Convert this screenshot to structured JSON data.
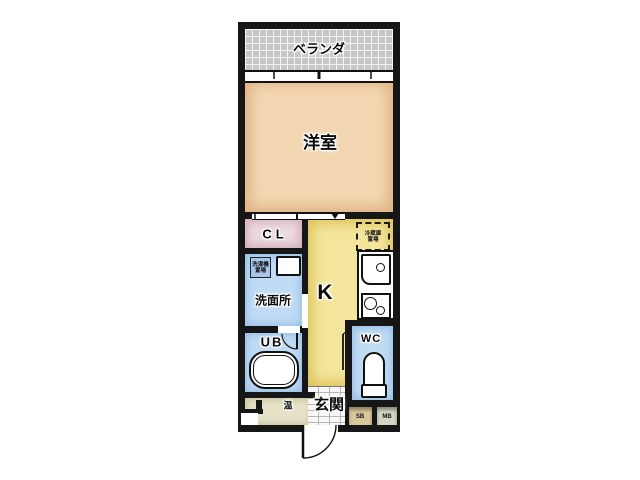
{
  "plan": {
    "type": "japanese-apartment-floor-plan",
    "rooms": {
      "veranda": {
        "label": "ベランダ"
      },
      "western_room": {
        "label": "洋室"
      },
      "closet": {
        "label": "CL"
      },
      "washroom": {
        "label": "洗面所"
      },
      "kitchen": {
        "label": "K"
      },
      "unit_bath": {
        "label": "UB"
      },
      "toilet": {
        "label": "WC"
      },
      "entrance": {
        "label": "玄関"
      },
      "water_heater": {
        "label": "温"
      },
      "shoe_box": {
        "label": "SB"
      },
      "meter_box": {
        "label": "MB"
      }
    },
    "appliance_notes": {
      "washer_line1": "洗濯機",
      "washer_line2": "置場",
      "fridge_line1": "冷蔵庫",
      "fridge_line2": "置場"
    },
    "colors": {
      "wall": "#161616",
      "veranda": "#c7c7c7",
      "western_room": "#f3d7b2",
      "closet": "#ecd9e0",
      "washroom": "#c0dbf4",
      "kitchen": "#f3e59c",
      "unit_bath": "#c0dbf4",
      "toilet_room": "#c0dbf4",
      "water_heater_area": "#e6e2c8",
      "shoe_box": "#d8c79c",
      "meter_box": "#d2d6c2",
      "washer_pad": "#a6c6e8"
    }
  }
}
